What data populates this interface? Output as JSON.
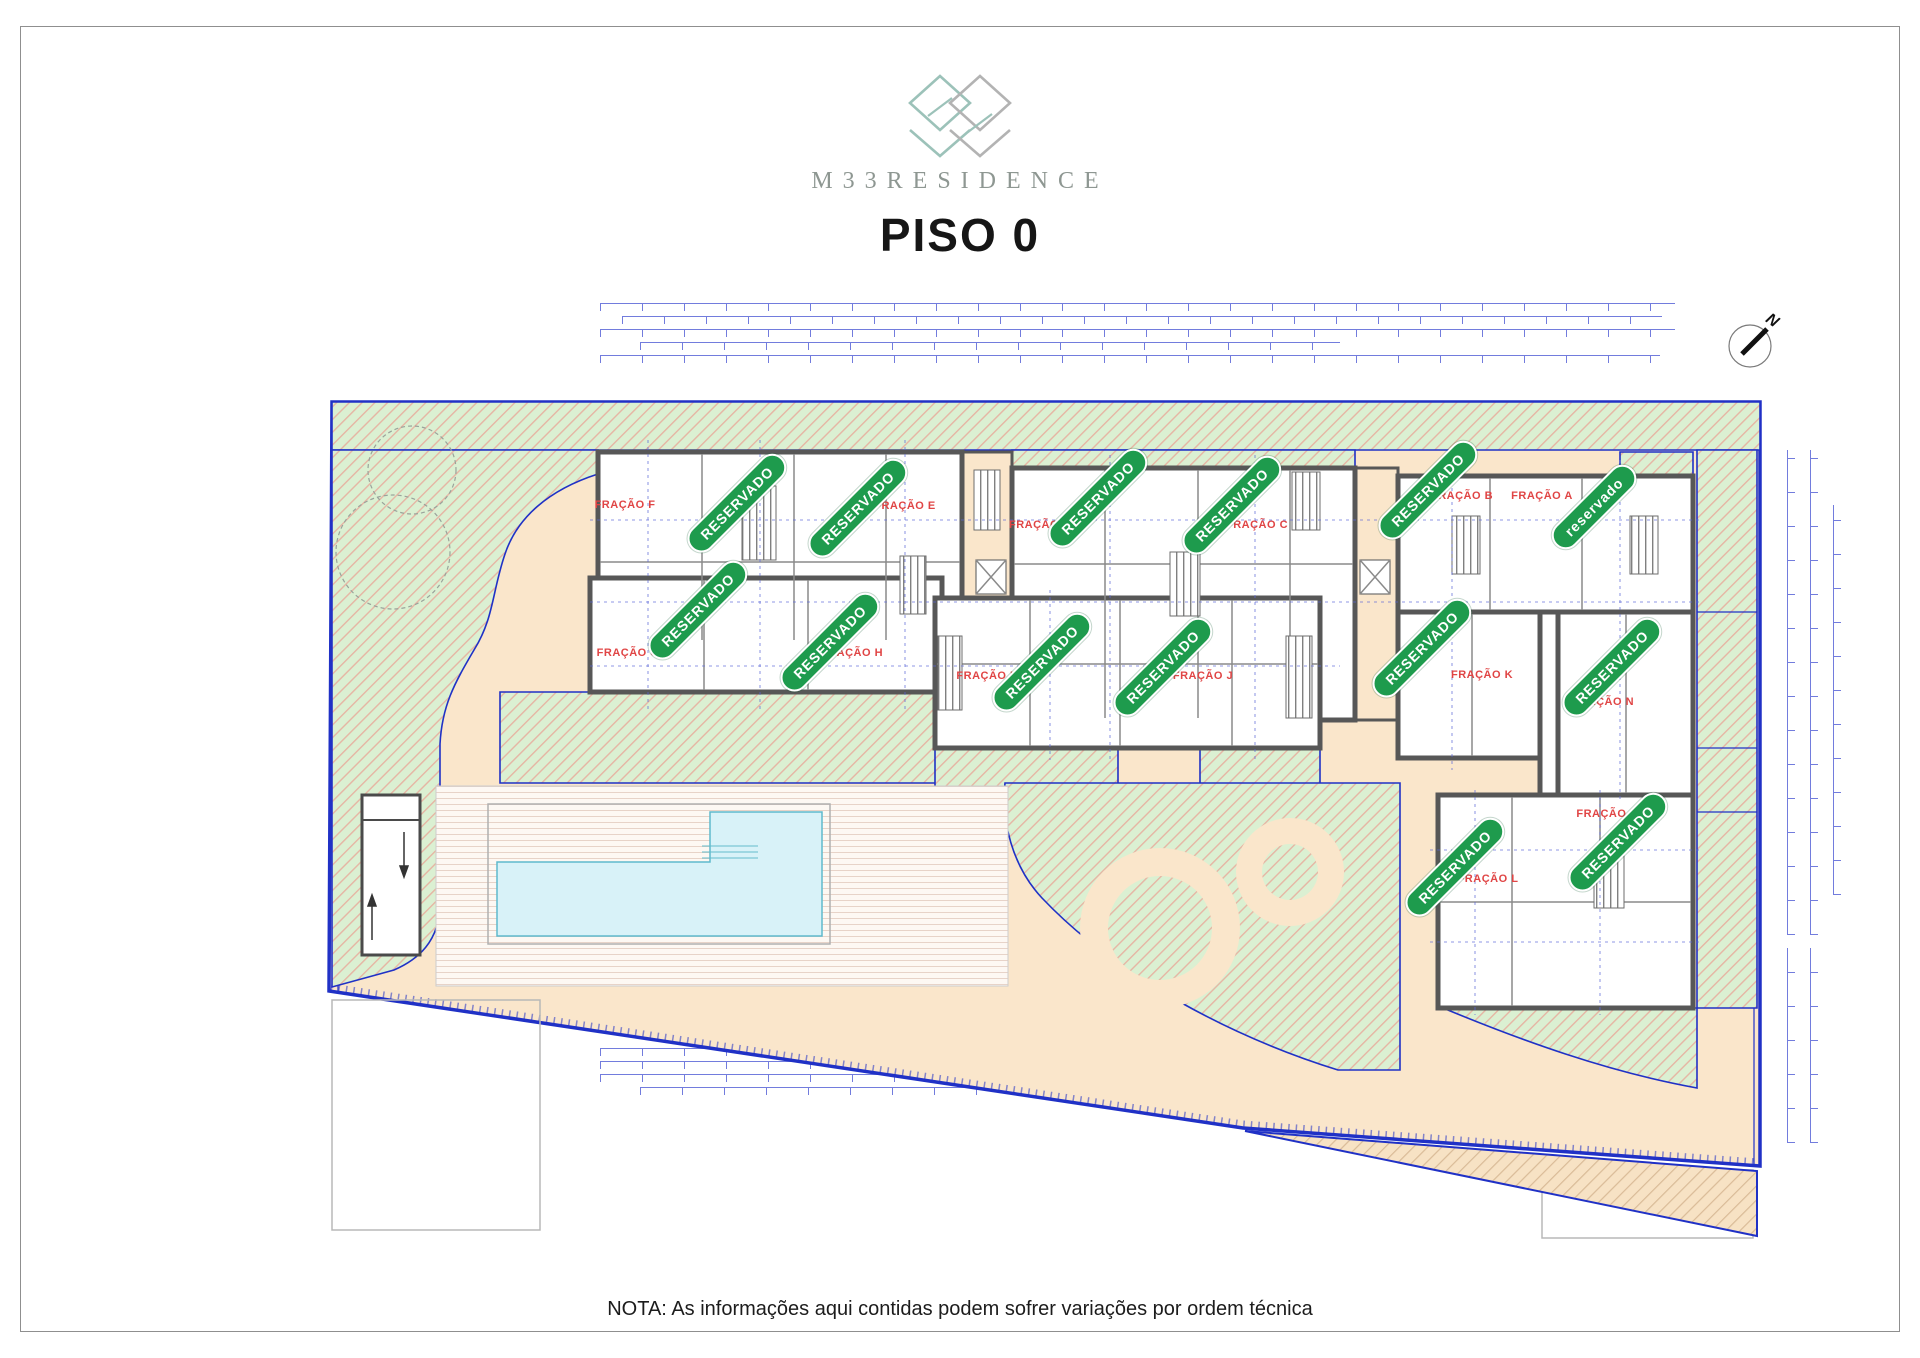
{
  "header": {
    "brand": "M33RESIDENCE",
    "title": "PISO 0"
  },
  "compass": {
    "label": "N"
  },
  "footer": {
    "note": "NOTA: As informações aqui contidas podem sofrer variações por ordem técnica"
  },
  "plan": {
    "units": [
      {
        "id": "fracao-f",
        "label": "FRAÇÃO F",
        "x": 625,
        "y": 505
      },
      {
        "id": "fracao-e",
        "label": "FRAÇÃO E",
        "x": 905,
        "y": 506
      },
      {
        "id": "fracao-d",
        "label": "FRAÇÃO D",
        "x": 1040,
        "y": 525
      },
      {
        "id": "fracao-c",
        "label": "FRAÇÃO C",
        "x": 1257,
        "y": 525
      },
      {
        "id": "fracao-b",
        "label": "FRAÇÃO B",
        "x": 1462,
        "y": 496
      },
      {
        "id": "fracao-a",
        "label": "FRAÇÃO A",
        "x": 1542,
        "y": 496
      },
      {
        "id": "fracao-g",
        "label": "FRAÇÃO G",
        "x": 628,
        "y": 653
      },
      {
        "id": "fracao-h",
        "label": "FRAÇÃO H",
        "x": 852,
        "y": 653
      },
      {
        "id": "fracao-i",
        "label": "FRAÇÃO I",
        "x": 985,
        "y": 676
      },
      {
        "id": "fracao-j",
        "label": "FRAÇÃO J",
        "x": 1203,
        "y": 676
      },
      {
        "id": "fracao-k",
        "label": "FRAÇÃO K",
        "x": 1482,
        "y": 675
      },
      {
        "id": "fracao-n",
        "label": "FRAÇÃO N",
        "x": 1603,
        "y": 702
      },
      {
        "id": "fracao-m",
        "label": "FRAÇÃO M",
        "x": 1608,
        "y": 814
      },
      {
        "id": "fracao-l",
        "label": "FRAÇÃO L",
        "x": 1488,
        "y": 879
      }
    ],
    "badges": [
      {
        "text": "RESERVADO",
        "x": 737,
        "y": 503
      },
      {
        "text": "RESERVADO",
        "x": 858,
        "y": 508
      },
      {
        "text": "RESERVADO",
        "x": 1098,
        "y": 498
      },
      {
        "text": "RESERVADO",
        "x": 1232,
        "y": 505
      },
      {
        "text": "RESERVADO",
        "x": 1428,
        "y": 490
      },
      {
        "text": "reservado",
        "x": 1594,
        "y": 507
      },
      {
        "text": "RESERVADO",
        "x": 698,
        "y": 610
      },
      {
        "text": "RESERVADO",
        "x": 830,
        "y": 642
      },
      {
        "text": "RESERVADO",
        "x": 1042,
        "y": 662
      },
      {
        "text": "RESERVADO",
        "x": 1163,
        "y": 667
      },
      {
        "text": "RESERVADO",
        "x": 1422,
        "y": 648
      },
      {
        "text": "RESERVADO",
        "x": 1612,
        "y": 667
      },
      {
        "text": "RESERVADO",
        "x": 1618,
        "y": 842
      },
      {
        "text": "RESERVADO",
        "x": 1455,
        "y": 867
      }
    ]
  },
  "colors": {
    "peach": "#fae6cb",
    "lawn": "#dbf0d2",
    "lawnline": "#e6b5a3",
    "pool": "#d8f2f8",
    "blue": "#2031c6",
    "dimblue": "#5a66d8",
    "wall": "#575757",
    "badge": "#1e9b4d",
    "red": "#e04545",
    "teal": "#9cc2b9",
    "lgray": "#b3b3b3",
    "deckline": "#e7d3c8",
    "tanline": "#d9bb97"
  }
}
